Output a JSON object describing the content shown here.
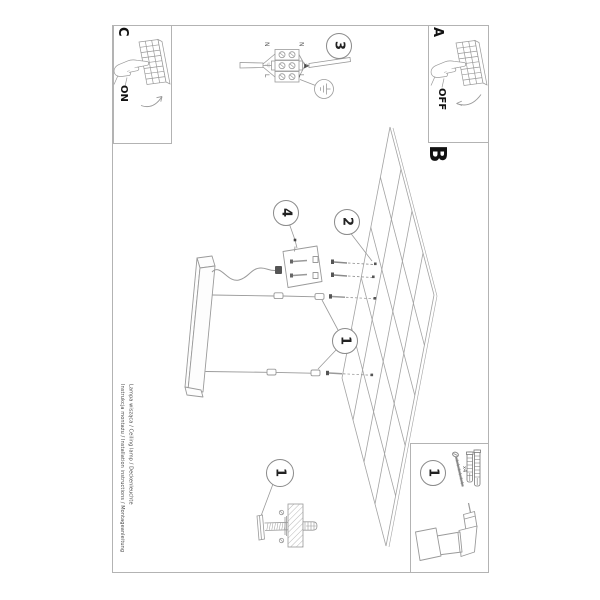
{
  "document": {
    "type_label": "installation manual page (rotated 90°)",
    "sections": {
      "a_label": "A",
      "b_label": "B",
      "c_label": "C"
    },
    "switch_on_label": "ON",
    "switch_off_label": "OFF",
    "steps": {
      "wiring": "3",
      "canopy": "4",
      "grid": "2",
      "suspension": "1"
    },
    "detail_callout": "1",
    "parts": {
      "callout": "1",
      "quantity": "x4"
    },
    "wiring_labels": {
      "n_left": "N",
      "n_right": "N",
      "l_left": "L",
      "l_right": "L"
    },
    "footer": {
      "line1": "Instrukcja montażu / Installation instructions / Montageanleitung",
      "line2": "Lampa wisząca / Ceiling lamp / Deckenleuchte"
    }
  },
  "colors": {
    "line": "#9a9a9a",
    "border": "#b3b3b3",
    "text": "#1a1a1a",
    "accent_dark": "#555555"
  }
}
